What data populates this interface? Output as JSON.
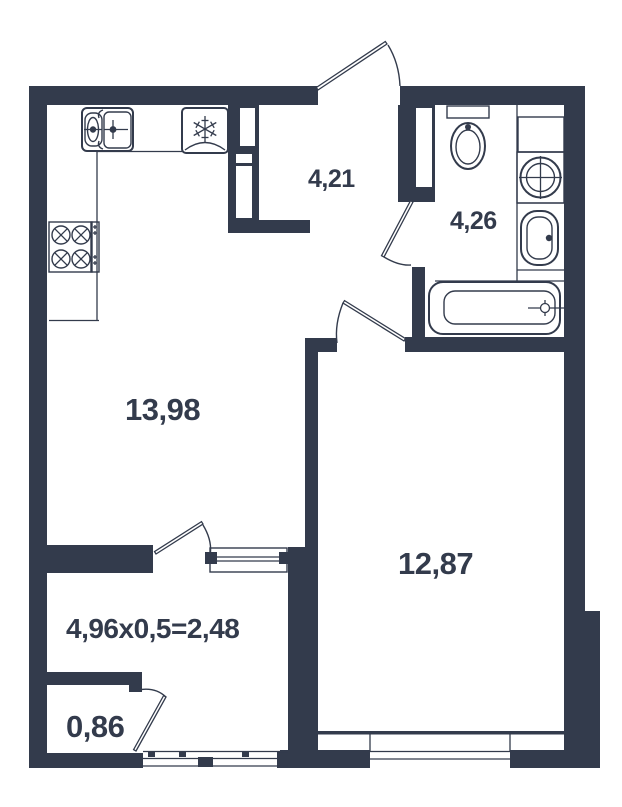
{
  "colors": {
    "wall": "#333B4C",
    "background": "#FFFFFF"
  },
  "labels": {
    "hallway_area": "4,21",
    "bathroom_area": "4,26",
    "kitchen_living_area": "13,98",
    "room_area": "12,87",
    "loggia_area_formula": "4,96x0,5=2,48",
    "storage_area": "0,86"
  },
  "fixtures": {
    "kitchen_sink": "kitchen-sink-icon",
    "stove": "stove-4-burner-icon",
    "fridge": "refrigerator-snowflake-icon",
    "toilet": "toilet-icon",
    "washing_machine": "washing-machine-icon",
    "bathroom_sink": "washbasin-icon",
    "bathtub": "bathtub-icon"
  }
}
